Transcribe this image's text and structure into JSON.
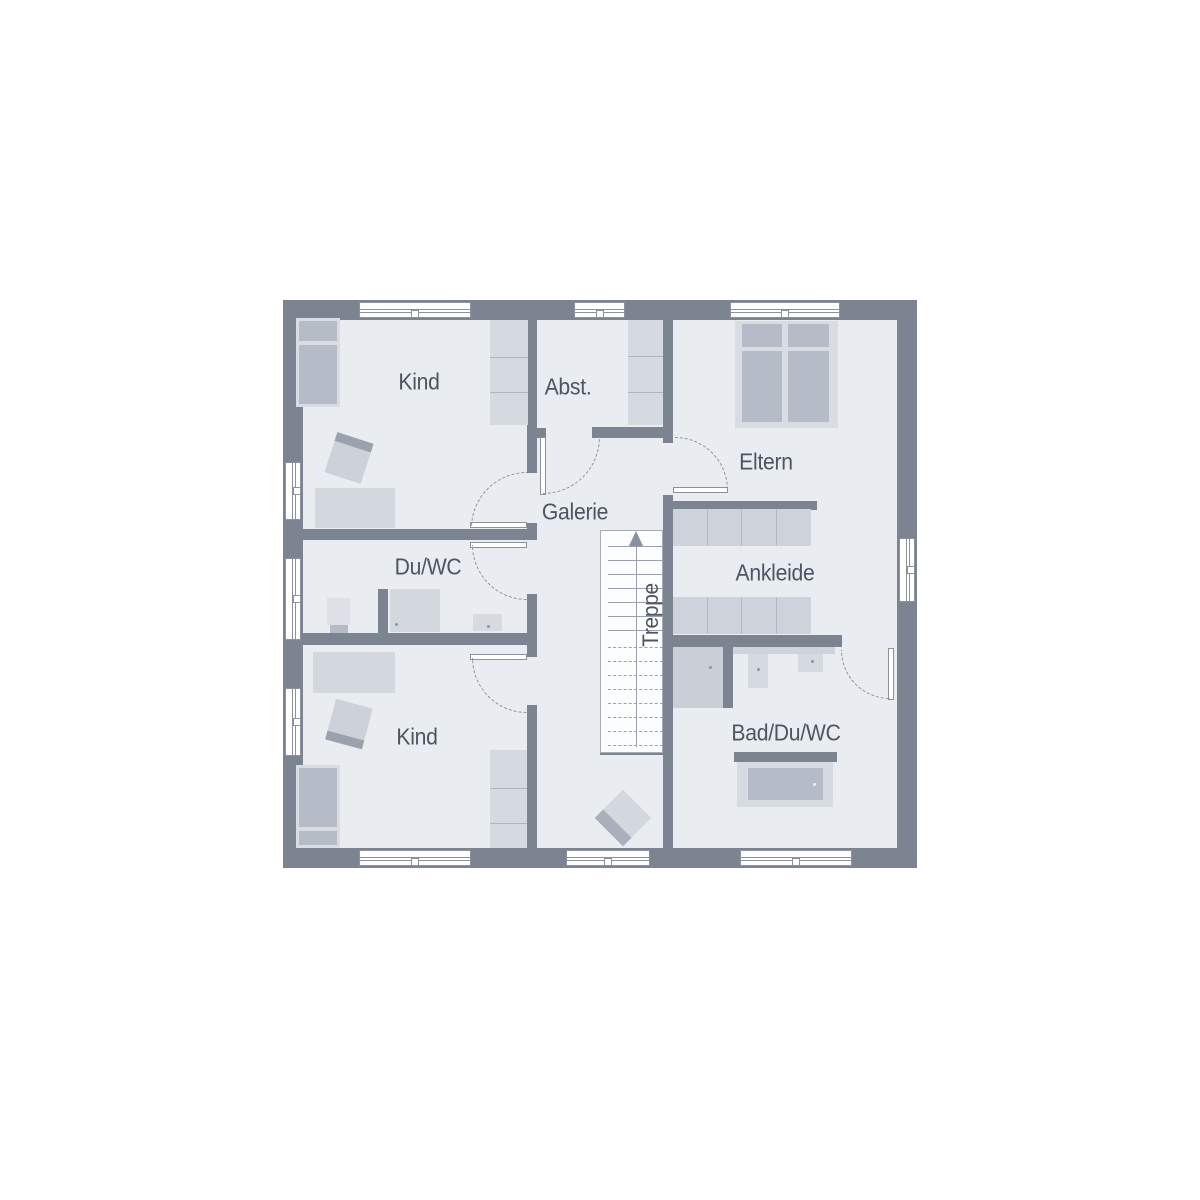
{
  "document": {
    "type": "floor-plan",
    "floor": "upper-floor",
    "language": "German"
  },
  "palette": {
    "wall": "#7b8490",
    "floor": "#e9ecf1",
    "furniture_light": "#d5d9e0",
    "furniture_medium": "#b6bcc7",
    "outline": "#8b929e",
    "text": "#4c5560",
    "background": "#ffffff"
  },
  "rooms": {
    "kind_top": {
      "label": "Kind"
    },
    "abst": {
      "label": "Abst."
    },
    "eltern": {
      "label": "Eltern"
    },
    "galerie": {
      "label": "Galerie"
    },
    "du_wc": {
      "label": "Du/WC"
    },
    "ankleide": {
      "label": "Ankleide"
    },
    "kind_bottom": {
      "label": "Kind"
    },
    "bad_du_wc": {
      "label": "Bad/Du/WC"
    },
    "treppe": {
      "label": "Treppe"
    }
  },
  "stairs": {
    "label": "Treppe",
    "direction": "up"
  }
}
